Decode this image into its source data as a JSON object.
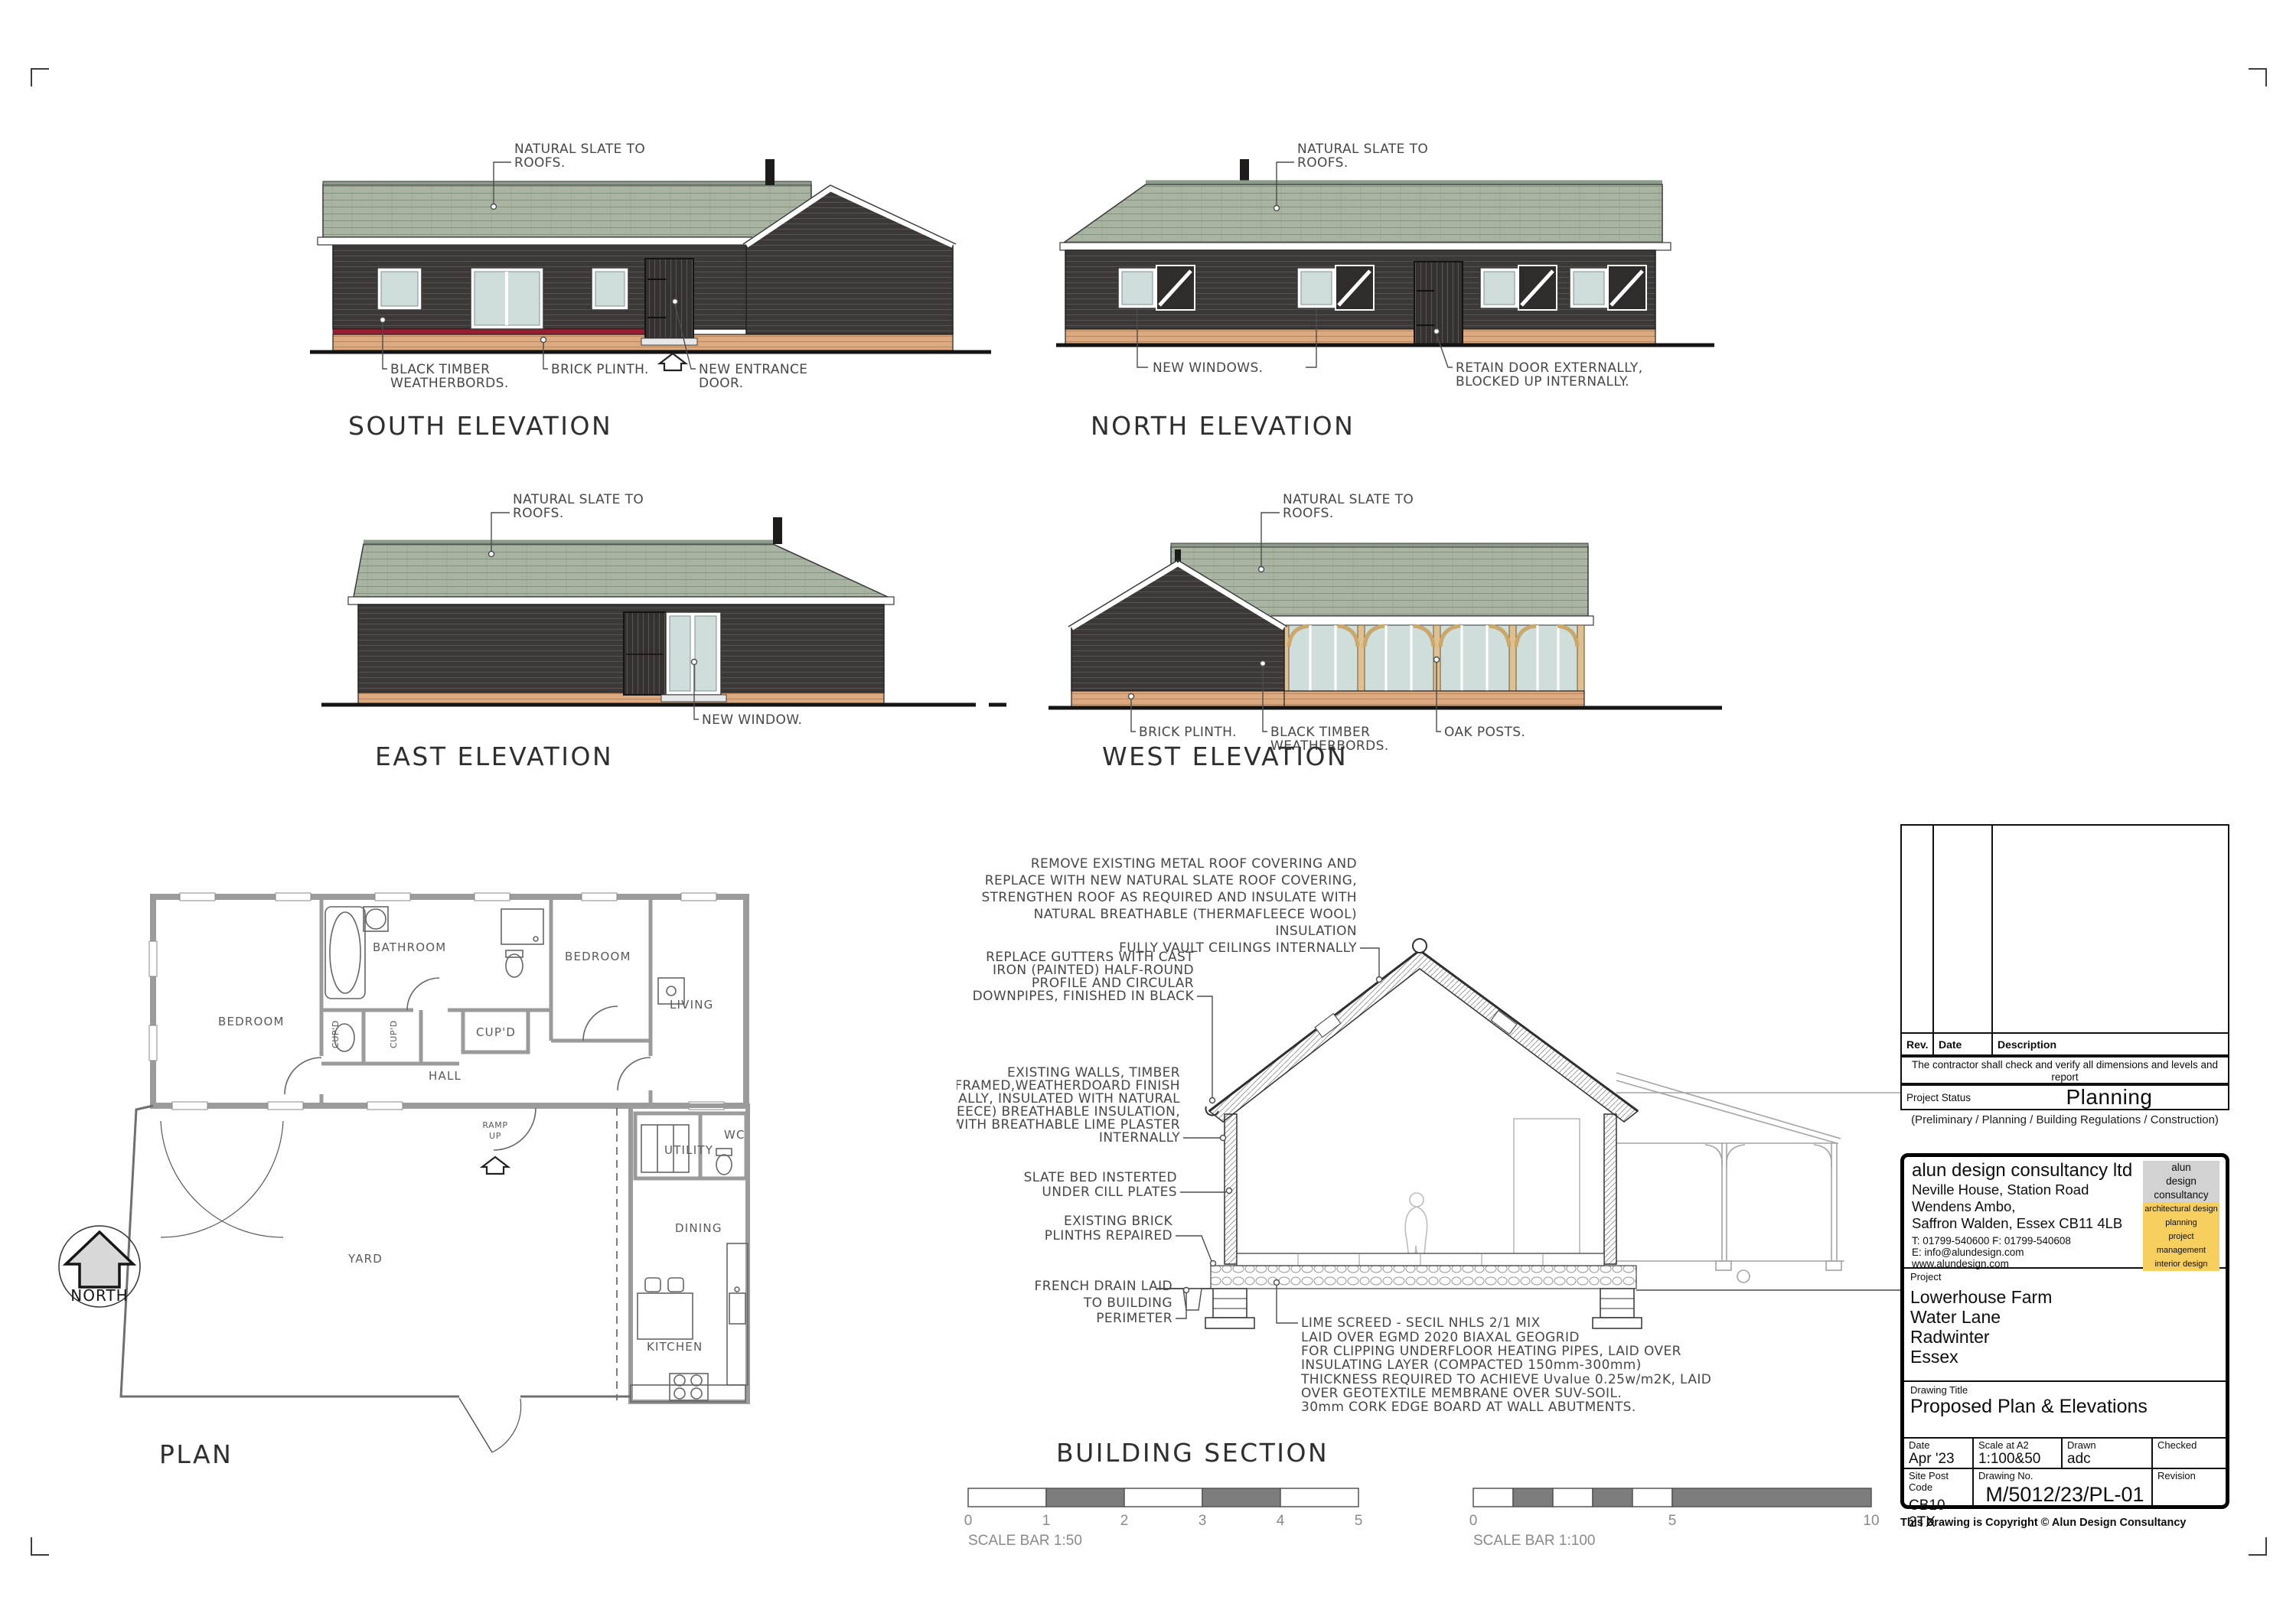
{
  "colors": {
    "slate": "#a9b4a2",
    "wall": "#3b3837",
    "plinth": "#dcaa80",
    "red_band": "#9c1b31",
    "glass": "#cfdeda",
    "oak": "#dfc08e",
    "logo_gray": "#d2d2d2",
    "logo_yellow": "#f7cf5f"
  },
  "elevations": {
    "south": {
      "title": "SOUTH ELEVATION",
      "roof": [
        "NATURAL SLATE TO",
        "ROOFS."
      ],
      "timber": [
        "BLACK TIMBER",
        "WEATHERBORDS."
      ],
      "plinth": "BRICK PLINTH.",
      "door": [
        "NEW ENTRANCE",
        "DOOR."
      ]
    },
    "north": {
      "title": "NORTH ELEVATION",
      "roof": [
        "NATURAL SLATE TO",
        "ROOFS."
      ],
      "windows": "NEW WINDOWS.",
      "door": [
        "RETAIN DOOR EXTERNALLY,",
        "BLOCKED UP INTERNALLY."
      ]
    },
    "east": {
      "title": "EAST ELEVATION",
      "roof": [
        "NATURAL SLATE TO",
        "ROOFS."
      ],
      "window": "NEW WINDOW."
    },
    "west": {
      "title": "WEST ELEVATION",
      "roof": [
        "NATURAL SLATE TO",
        "ROOFS."
      ],
      "plinth": "BRICK PLINTH.",
      "timber": [
        "BLACK TIMBER",
        "WEATHERBORDS."
      ],
      "posts": "OAK POSTS."
    }
  },
  "plan": {
    "title": "PLAN",
    "north": "NORTH",
    "rooms": {
      "bedroom1": "BEDROOM",
      "bathroom": "BATHROOM",
      "bedroom2": "BEDROOM",
      "living": "LIVING",
      "cupd1": "CUP'D",
      "cupd2": "CUP'D",
      "cupd3": "CUP'D",
      "hall": "HALL",
      "ramp1": "RAMP",
      "ramp2": "UP",
      "utility": "UTILITY",
      "wc": "WC",
      "yard": "YARD",
      "dining": "DINING",
      "kitchen": "KITCHEN"
    }
  },
  "section": {
    "title": "BUILDING SECTION",
    "notes": {
      "roof": [
        "REMOVE EXISTING METAL ROOF COVERING AND",
        "REPLACE WITH NEW NATURAL SLATE ROOF COVERING,",
        "STRENGTHEN ROOF AS REQUIRED AND INSULATE WITH",
        "NATURAL BREATHABLE (THERMAFLEECE WOOL)",
        "INSULATION"
      ],
      "ceiling": "FULLY VAULT CEILINGS INTERNALLY",
      "gutters": [
        "REPLACE GUTTERS WITH CAST",
        "IRON  (PAINTED) HALF-ROUND",
        "PROFILE AND CIRCULAR",
        "DOWNPIPES, FINISHED IN BLACK"
      ],
      "walls": [
        "EXISTING WALLS, TIMBER",
        "FRAMED,WEATHERDOARD FINISH",
        "EXTERNALLY, INSULATED WITH NATURAL",
        "(THERMAFLEECE) BREATHABLE INSULATION,",
        "FINISHED WITH BREATHABLE LIME PLASTER",
        "INTERNALLY"
      ],
      "slate_bed": [
        "SLATE BED INSTERTED",
        "UNDER CILL PLATES"
      ],
      "plinths": [
        "EXISTING BRICK",
        "PLINTHS REPAIRED"
      ],
      "drain": [
        "FRENCH DRAIN LAID",
        "TO BUILDING",
        "PERIMETER"
      ],
      "screed": [
        "LIME SCREED - SECIL NHLS 2/1 MIX",
        "LAID OVER EGMD 2020 BIAXAL GEOGRID",
        "FOR CLIPPING UNDERFLOOR HEATING PIPES, LAID OVER",
        "INSULATING LAYER (COMPACTED 150mm-300mm)",
        "THICKNESS REQUIRED TO ACHIEVE Uvalue 0.25w/m2K, LAID",
        "OVER GEOTEXTILE MEMBRANE OVER SUV-SOIL.",
        "30mm CORK EDGE BOARD AT WALL ABUTMENTS."
      ]
    }
  },
  "scalebars": {
    "b50": {
      "label": "SCALE BAR 1:50",
      "ticks": [
        "0",
        "1",
        "2",
        "3",
        "4",
        "5"
      ]
    },
    "b100": {
      "label": "SCALE BAR 1:100",
      "ticks": [
        "0",
        "5",
        "10"
      ]
    }
  },
  "titleblock": {
    "rev": "Rev.",
    "date": "Date",
    "desc": "Description",
    "note1": "The contractor shall check and verify all dimensions and levels  and report",
    "note2": "any apparent discrepancies to the architect prior  to commencing work.",
    "status_label": "Project Status",
    "status": "Planning",
    "options": "(Preliminary / Planning / Building Regulations / Construction)",
    "company": {
      "name": "alun design consultancy ltd",
      "addr1": "Neville House, Station Road",
      "addr2": "Wendens Ambo,",
      "addr3": "Saffron Walden, Essex CB11 4LB",
      "tel": "T:  01799-540600  F:  01799-540608",
      "email": "E:  info@alundesign.com",
      "web": "www.alundesign.com"
    },
    "logo": {
      "l1": "alun",
      "l2": "design",
      "l3": "consultancy",
      "y1": "architectural design",
      "y2": "planning",
      "y3": "project management",
      "y4": "interior design"
    },
    "project_label": "Project",
    "proj1": "Lowerhouse Farm",
    "proj2": "Water Lane",
    "proj3": "Radwinter",
    "proj4": "Essex",
    "dt_label": "Drawing Title",
    "dt": "Proposed Plan & Elevations",
    "f": {
      "date_l": "Date",
      "date": "Apr '23",
      "scale_l": "Scale at A2",
      "scale": "1:100&50",
      "drawn_l": "Drawn",
      "drawn": "adc",
      "checked_l": "Checked",
      "checked": "",
      "pc_l": "Site Post Code",
      "pc": "CB10 2TX",
      "no_l": "Drawing No.",
      "no": "M/5012/23/PL-01",
      "rev_l": "Revision",
      "rev_v": ""
    },
    "copyright": "This Drawing is Copyright © Alun Design Consultancy"
  }
}
